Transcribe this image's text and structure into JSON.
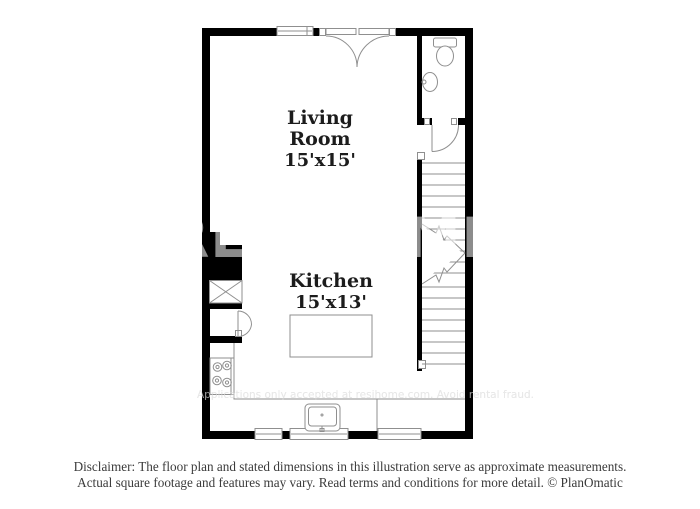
{
  "floor_plan": {
    "rooms": [
      {
        "name": "Living Room",
        "dimensions": "15'x15'"
      },
      {
        "name": "Kitchen",
        "dimensions": "15'x13'"
      }
    ],
    "fixtures": [
      "french-doors",
      "window",
      "toilet",
      "bathroom-sink",
      "bathroom-door",
      "staircase",
      "water-heater",
      "bifold-closet-door",
      "stove",
      "kitchen-island",
      "kitchen-sink",
      "counter"
    ],
    "watermarks": {
      "large": "RESIHOME",
      "small": "Applications only accepted at resihome.com. Avoid rental fraud."
    }
  },
  "disclaimer": {
    "line1": "Disclaimer: The floor plan and stated dimensions in this illustration serve as approximate measurements.",
    "line2": "Actual square footage and features may vary. Read terms and conditions for more detail. © PlanOmatic"
  },
  "colors": {
    "wall": "#000000",
    "fixture_line": "#8f8f8f",
    "label_text": "#1c1c1c",
    "disclaimer_text": "#3b3b3b"
  }
}
